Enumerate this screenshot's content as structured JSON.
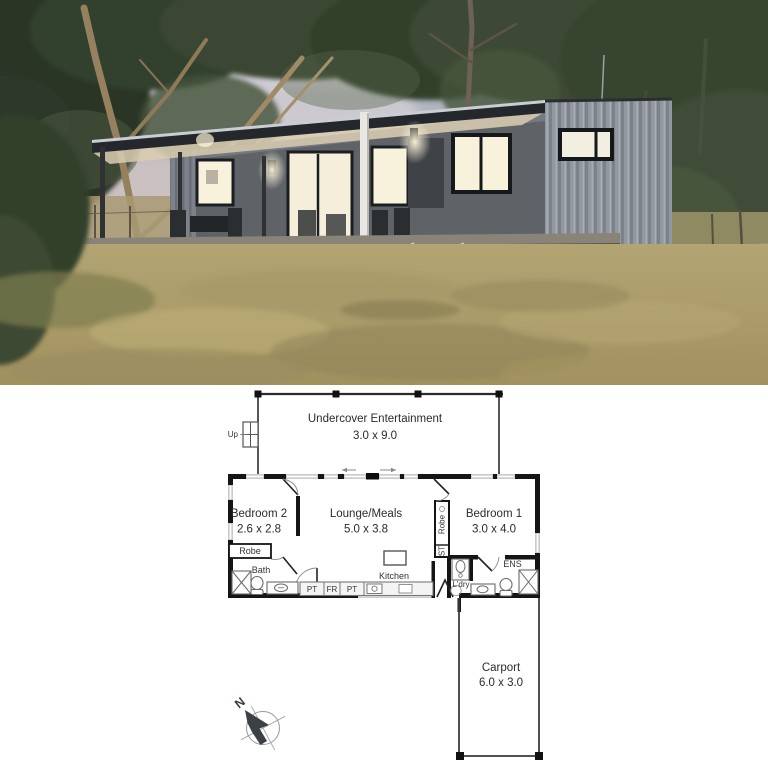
{
  "photo": {
    "palette": {
      "sky": "#8ea0b2",
      "clouds": "#d8d2d4",
      "foliage": "#35462f",
      "cladding": "#8f949a",
      "roof_fascia": "#24272b",
      "window_glow": "#f8f2dd",
      "deck": "#6b655c",
      "grass": "#b0a271",
      "gravel": "#99928a"
    }
  },
  "floor_plan": {
    "areas": [
      {
        "name": "Undercover Entertainment",
        "dims": "3.0 x 9.0"
      },
      {
        "name": "Bedroom 2",
        "dims": "2.6 x 2.8"
      },
      {
        "name": "Lounge/Meals",
        "dims": "5.0 x 3.8"
      },
      {
        "name": "Bedroom 1",
        "dims": "3.0 x 4.0"
      },
      {
        "name": "Carport",
        "dims": "6.0 x 3.0"
      }
    ],
    "labels": {
      "up": "Up",
      "robe_bedroom2": "Robe",
      "bath": "Bath",
      "pantry_left": "PT",
      "fridge": "FR",
      "pantry_right": "PT",
      "kitchen": "Kitchen",
      "robe_bedroom1": "Robe",
      "store": "ST",
      "laundry": "L'dry",
      "ensuite": "ENS",
      "compass_north": "N"
    }
  }
}
